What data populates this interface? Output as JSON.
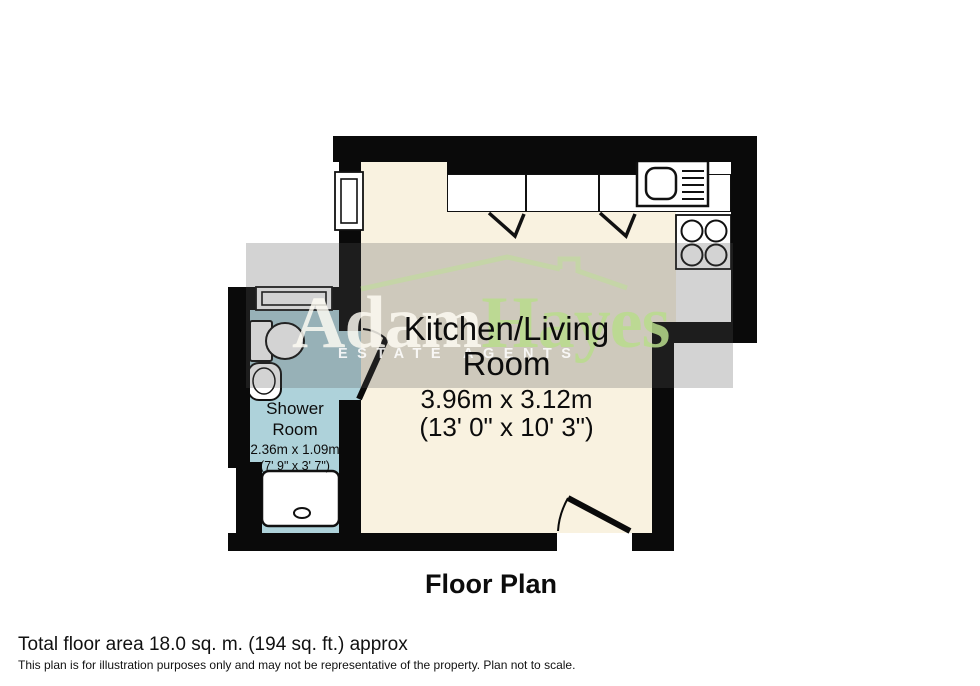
{
  "title": "Floor Plan",
  "watermark": {
    "brand_first": "Adam",
    "brand_second": "Hayes",
    "tagline": "ESTATE AGENTS"
  },
  "rooms": {
    "kitchen": {
      "label_line1": "Kitchen/Living",
      "label_line2": "Room",
      "dims_metric": "3.96m x 3.12m",
      "dims_imperial": "(13' 0\" x 10' 3\")"
    },
    "shower": {
      "label_line1": "Shower",
      "label_line2": "Room",
      "dims_metric": "2.36m x 1.09m",
      "dims_imperial": "(7' 9\" x 3' 7\")"
    }
  },
  "fixtures": [
    "sink-drainer",
    "hob-4-burner",
    "toilet",
    "basin",
    "shower-tray",
    "window-kitchen",
    "window-shower",
    "door-swing-interior",
    "door-swing-entry",
    "cabinet-marks"
  ],
  "footer": {
    "total_area": "Total floor area 18.0 sq. m. (194 sq. ft.) approx",
    "disclaimer": "This plan is for illustration purposes only and may not be representative of the property. Plan not to scale."
  },
  "colors": {
    "wall": "#0a0a0a",
    "kitchen_floor": "#f9f2e0",
    "shower_floor": "#aed2da",
    "overlay": "rgba(85,85,85,0.26)",
    "wm_green": "rgba(185,220,140,0.85)",
    "wm_cream": "rgba(255,253,244,0.82)",
    "wm_roof": "rgba(190,222,150,0.55)"
  }
}
